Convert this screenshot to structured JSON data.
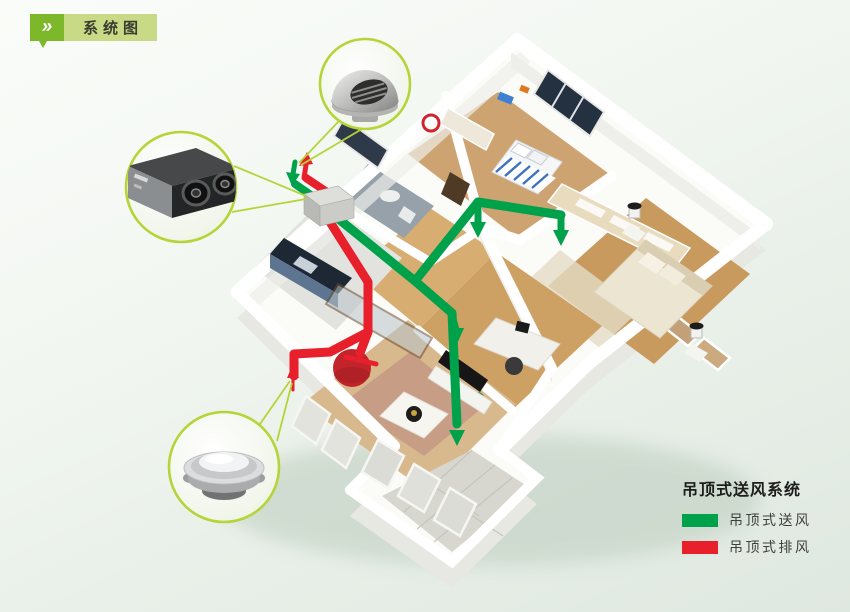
{
  "header": {
    "icon": "double-chevron-icon",
    "glyph": "»",
    "label": "系统图"
  },
  "legend": {
    "title": "吊顶式送风系统",
    "items": [
      {
        "label": "吊顶式送风",
        "color": "#00A14B"
      },
      {
        "label": "吊顶式排风",
        "color": "#E8202C"
      }
    ]
  },
  "callouts": [
    {
      "icon": "outdoor-wall-cap-icon"
    },
    {
      "icon": "ventilation-unit-icon"
    },
    {
      "icon": "ceiling-diffuser-icon"
    }
  ],
  "colors": {
    "supply_duct": "#00A14B",
    "exhaust_duct": "#E8202C",
    "badge_green": "#7CB829",
    "badge_light_green": "#C9DA86",
    "callout_ring": "#B5D438"
  }
}
